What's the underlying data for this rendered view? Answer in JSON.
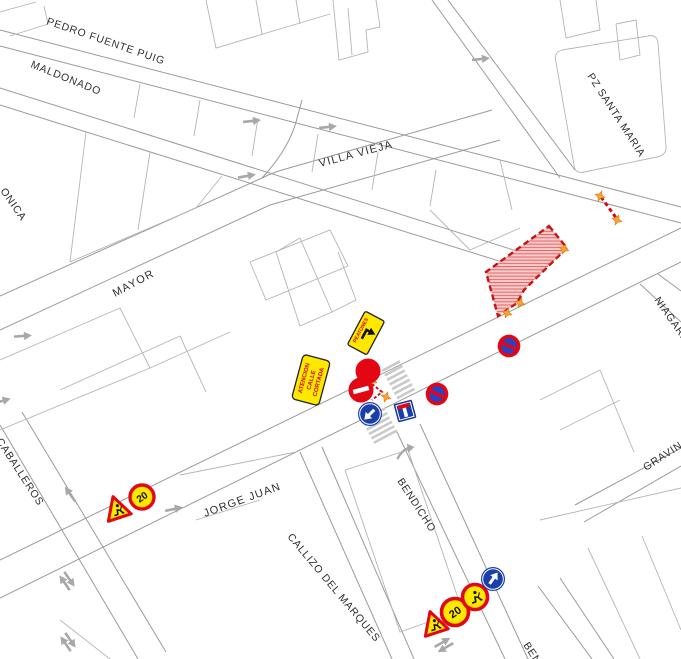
{
  "map": {
    "type": "traffic-works-plan",
    "streets": [
      {
        "id": "pedro-fuente-puig",
        "text": "PEDRO FUENTE PUIG"
      },
      {
        "id": "maldonado",
        "text": "MALDONADO"
      },
      {
        "id": "veronica-partial",
        "text": "ONICA"
      },
      {
        "id": "mayor",
        "text": "MAYOR"
      },
      {
        "id": "villa-vieja",
        "text": "VILLA VIEJA"
      },
      {
        "id": "pz-santa-maria",
        "text": "PZ SANTA MARIA"
      },
      {
        "id": "niagara",
        "text": "NIAGARA"
      },
      {
        "id": "gravina",
        "text": "GRAVINA"
      },
      {
        "id": "caballeros",
        "text": "CABALLEROS"
      },
      {
        "id": "jorge-juan",
        "text": "JORGE JUAN"
      },
      {
        "id": "bendicho",
        "text": "BENDICHO"
      },
      {
        "id": "callizo-del-marques",
        "text": "CALLIZO DEL MARQUES"
      },
      {
        "id": "ben-partial",
        "text": "BEN"
      }
    ],
    "signs": {
      "attention_panel_lines": [
        "ATENCION",
        "CALLE",
        "CORTADA"
      ],
      "pedestrian_panel_text": "PEATONES",
      "speed_limit_value": "20",
      "placed_symbols": [
        "roadworks-warning-panel",
        "pedestrian-detour-panel",
        "red-closure-dot",
        "no-entry",
        "mandatory-direction-down-left",
        "dead-end",
        "no-parking",
        "no-parking",
        "speed-limit-20",
        "roadworks-triangle",
        "roadworks-triangle",
        "speed-limit-20",
        "roadworks-circle",
        "mandatory-direction-up-right"
      ],
      "cone_count": 7,
      "crosswalk_count": 2,
      "direction_arrow_count": 12
    },
    "work_zone": {
      "shape": "hatched-polygon",
      "fill": "#f8caca",
      "hatch_color": "#e25b5b",
      "border_color": "#cc1111",
      "border_style": "dashed"
    },
    "colors": {
      "sign_red": "#e30613",
      "sign_blue": "#1b3faa",
      "sign_yellow": "#ffe800",
      "cone_orange": "#f6a13a",
      "road_line": "#9a9a9a",
      "parcel_line": "#b5b5b5",
      "label_color": "#2f2f2f",
      "arrow_gray": "#a8a8a8"
    }
  }
}
